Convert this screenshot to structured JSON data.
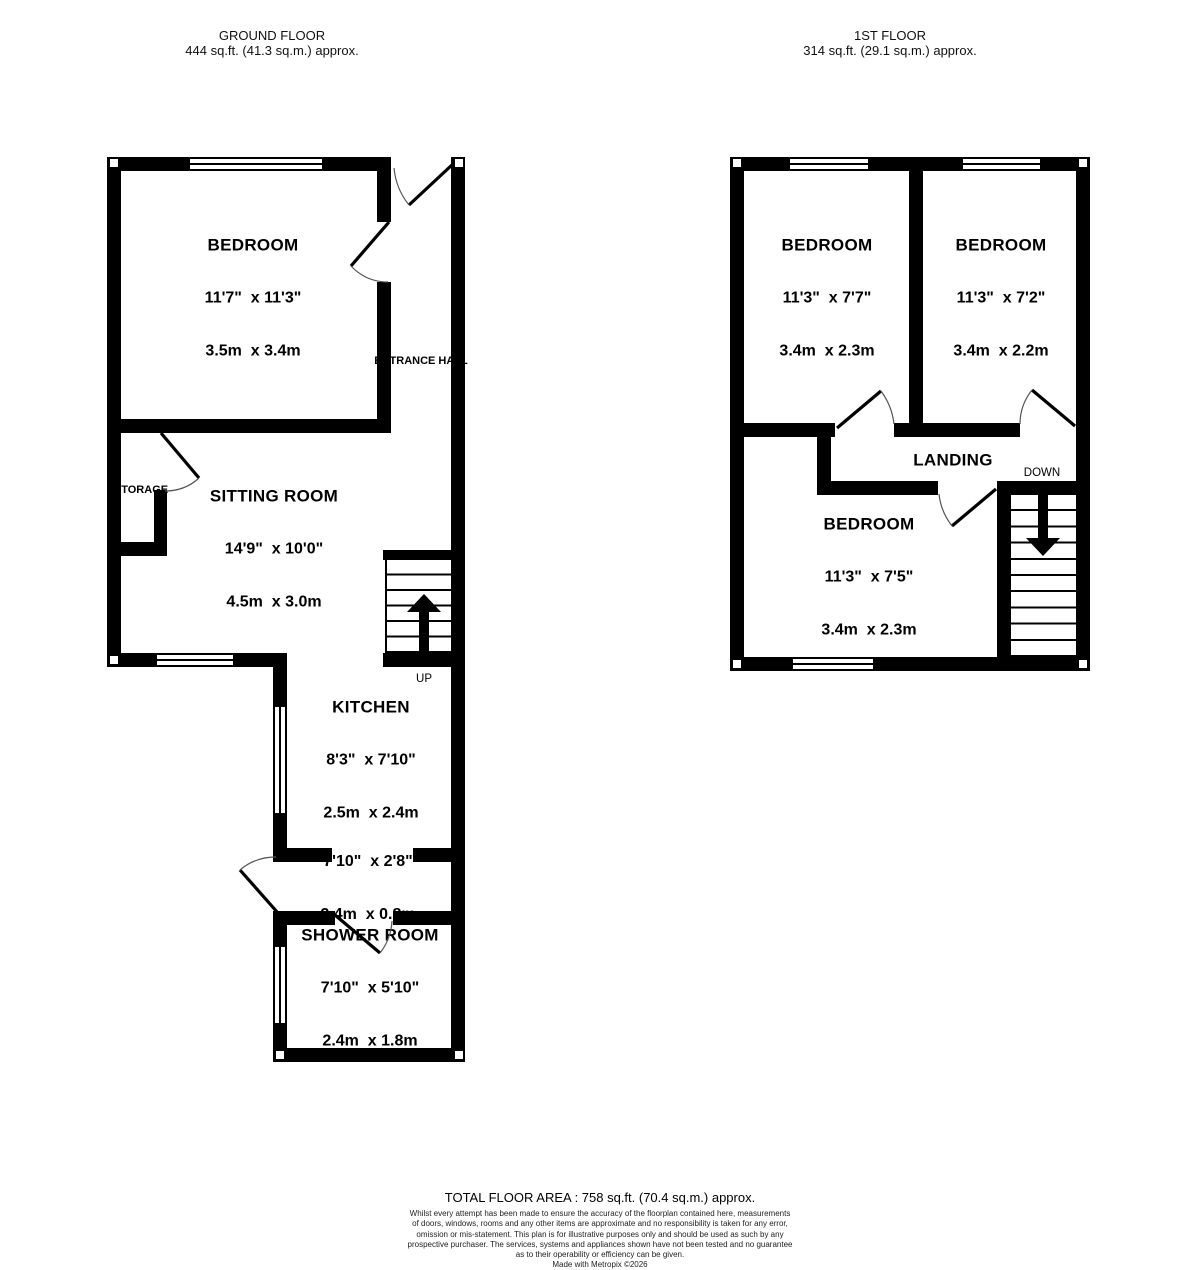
{
  "headers": {
    "ground_floor": {
      "title": "GROUND FLOOR",
      "area": "444 sq.ft. (41.3 sq.m.) approx."
    },
    "first_floor": {
      "title": "1ST FLOOR",
      "area": "314 sq.ft. (29.1 sq.m.) approx."
    }
  },
  "ground_floor": {
    "bedroom": {
      "name": "BEDROOM",
      "imperial": "11'7\"  x 11'3\"",
      "metric": "3.5m  x 3.4m"
    },
    "sitting_room": {
      "name": "SITTING ROOM",
      "imperial": "14'9\"  x 10'0\"",
      "metric": "4.5m  x 3.0m"
    },
    "kitchen": {
      "name": "KITCHEN",
      "imperial": "8'3\"  x 7'10\"",
      "metric": "2.5m  x 2.4m"
    },
    "lobby": {
      "imperial": "7'10\"  x 2'8\"",
      "metric": "2.4m  x 0.8m"
    },
    "shower_room": {
      "name": "SHOWER ROOM",
      "imperial": "7'10\"  x 5'10\"",
      "metric": "2.4m  x 1.8m"
    },
    "entrance_hall_label": "ENTRANCE HALL",
    "storage_label": "STORAGE",
    "stairs_label": "UP"
  },
  "first_floor": {
    "bedroom_left": {
      "name": "BEDROOM",
      "imperial": "11'3\"  x 7'7\"",
      "metric": "3.4m  x 2.3m"
    },
    "bedroom_right": {
      "name": "BEDROOM",
      "imperial": "11'3\"  x 7'2\"",
      "metric": "3.4m  x 2.2m"
    },
    "bedroom_bottom": {
      "name": "BEDROOM",
      "imperial": "11'3\"  x 7'5\"",
      "metric": "3.4m  x 2.3m"
    },
    "landing_label": "LANDING",
    "stairs_label": "DOWN"
  },
  "footer": {
    "total_area": "TOTAL FLOOR AREA : 758 sq.ft. (70.4 sq.m.) approx.",
    "disclaimer": [
      "Whilst every attempt has been made to ensure the accuracy of the floorplan contained here, measurements",
      "of doors, windows, rooms and any other items are approximate and no responsibility is taken for any error,",
      "omission or mis-statement. This plan is for illustrative purposes only and should be used as such by any",
      "prospective purchaser. The services, systems and appliances shown have not been tested and no guarantee",
      "as to their operability or efficiency can be given."
    ],
    "credit": "Made with Metropix ©2026"
  },
  "colors": {
    "wall": "#000000",
    "background": "#ffffff",
    "text": "#000000",
    "door_arc": "#555555"
  }
}
